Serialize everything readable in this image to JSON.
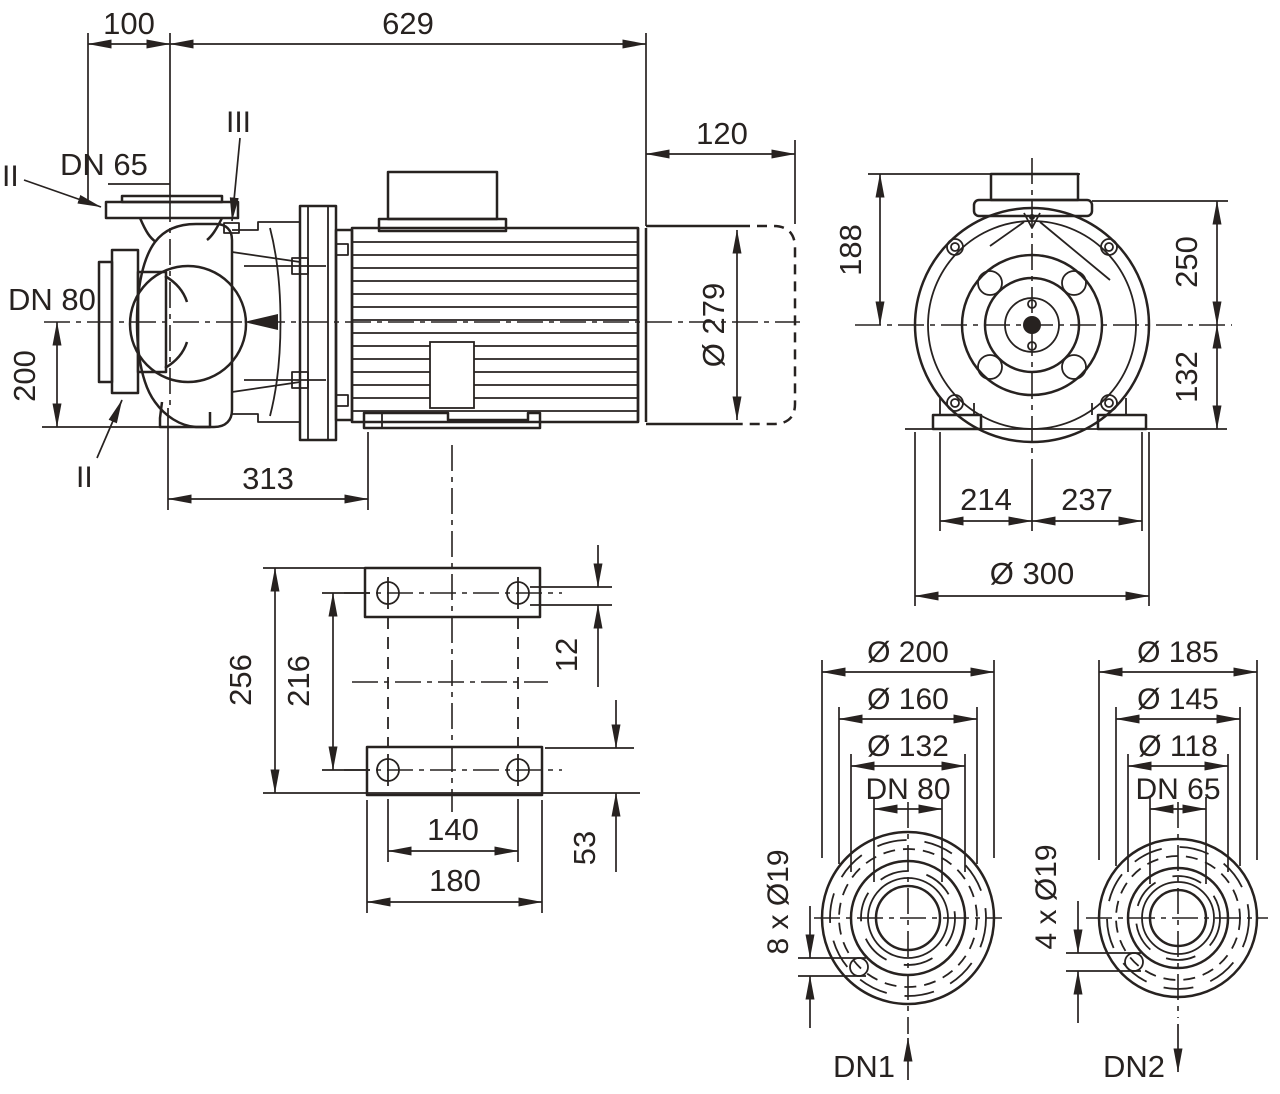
{
  "colors": {
    "ink": "#272220",
    "background": "#ffffff"
  },
  "views": {
    "side": {
      "dims": {
        "offset": "100",
        "length": "629",
        "fan_cover": "120",
        "motor_dia": "Ø 279",
        "suction_height": "200",
        "pump_length": "313"
      },
      "labels": {
        "discharge": "DN 65",
        "suction": "DN 80",
        "section_top": "II",
        "section_bottom": "II",
        "detail": "III"
      }
    },
    "front": {
      "dims": {
        "box_height": "188",
        "upper_height": "250",
        "lower_height": "132",
        "foot_left": "214",
        "foot_right": "237",
        "outer_dia": "Ø 300"
      }
    },
    "plan": {
      "dims": {
        "overall_depth": "256",
        "hole_pitch": "216",
        "top_offset": "12",
        "bottom_offset": "53",
        "hole_span": "140",
        "plate_width": "180"
      }
    },
    "flange_dn80": {
      "dims": {
        "outer": "Ø 200",
        "bolt_circle": "Ø 160",
        "face": "Ø 132",
        "nominal": "DN 80",
        "holes": "8 x Ø19"
      },
      "port": "DN1"
    },
    "flange_dn65": {
      "dims": {
        "outer": "Ø 185",
        "bolt_circle": "Ø 145",
        "face": "Ø 118",
        "nominal": "DN 65",
        "holes": "4 x Ø19"
      },
      "port": "DN2"
    }
  }
}
